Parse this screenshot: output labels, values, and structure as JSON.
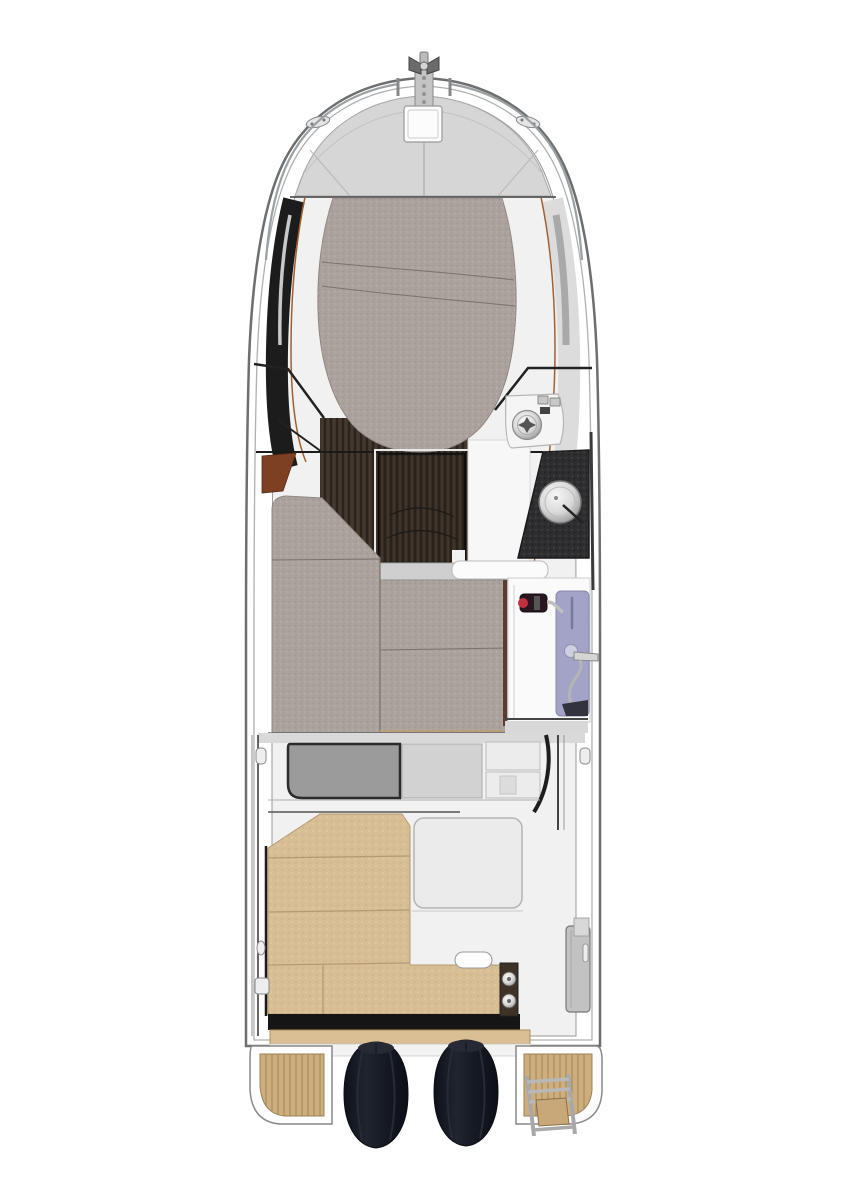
{
  "meta": {
    "title": "Motor-yacht deck plan, top view",
    "diagram_type": "boat-floorplan",
    "visible_text": []
  },
  "colors": {
    "background": "#ffffff",
    "hullStroke": "#6e6e6e",
    "hullInner": "#b0b0b0",
    "interior": "#f1f1f1",
    "deck": "#d6d6d6",
    "deckLine": "#aaaaaa",
    "glassDark": "#1c1c1c",
    "bandLight": "#dcdcdc",
    "woodTrim": "#a06030",
    "sunpad": "#aba29e",
    "sunpadEdge": "#8f8781",
    "seam": "#7a726c",
    "wood": "#3c332a",
    "woodDark": "#352c24",
    "brownSeat": "#7d4023",
    "counter": "#2e2e30",
    "lavender": "#a3a3c7",
    "pumpBody": "#2a1620",
    "pumpRed": "#c03040",
    "floorWhite": "#fafafa",
    "shelf": "#cfcfcf",
    "tanSeat": "#d8be95",
    "tanLine": "#b59a6f",
    "teak": "#cfae7d",
    "teakLine": "#9a8157",
    "teakStep": "#d9bf93",
    "blackTrim": "#151515",
    "engineDark": "#10131b",
    "hatchGray": "#9b9b9b",
    "lightPanel": "#d2d2d2",
    "locker": "#c2c2c2",
    "frame": "#222222",
    "rail": "#9aa0a4",
    "latchPanel": "#3f3125"
  },
  "regions": [
    {
      "id": "bow-fitting",
      "name": "anchor-roller-and-cross-bollard"
    },
    {
      "id": "foredeck",
      "name": "foredeck-with-anchor-hatch-and-cleats"
    },
    {
      "id": "sunpad",
      "name": "bow-sun-pad-cushion"
    },
    {
      "id": "cabin-sole",
      "name": "dark-wood-cabin-floor"
    },
    {
      "id": "companionway",
      "name": "companionway-steps-hatch"
    },
    {
      "id": "helm",
      "name": "helm-station-with-wheel"
    },
    {
      "id": "galley",
      "name": "galley-counter-with-sink"
    },
    {
      "id": "settee",
      "name": "saloon-berth-cushions"
    },
    {
      "id": "head",
      "name": "head-compartment-with-shower-column"
    },
    {
      "id": "cockpit",
      "name": "cockpit-with-u-shaped-bench"
    },
    {
      "id": "engines",
      "name": "twin-outboard-engines"
    },
    {
      "id": "platforms",
      "name": "swim-platforms-with-teak-and-ladder"
    }
  ]
}
